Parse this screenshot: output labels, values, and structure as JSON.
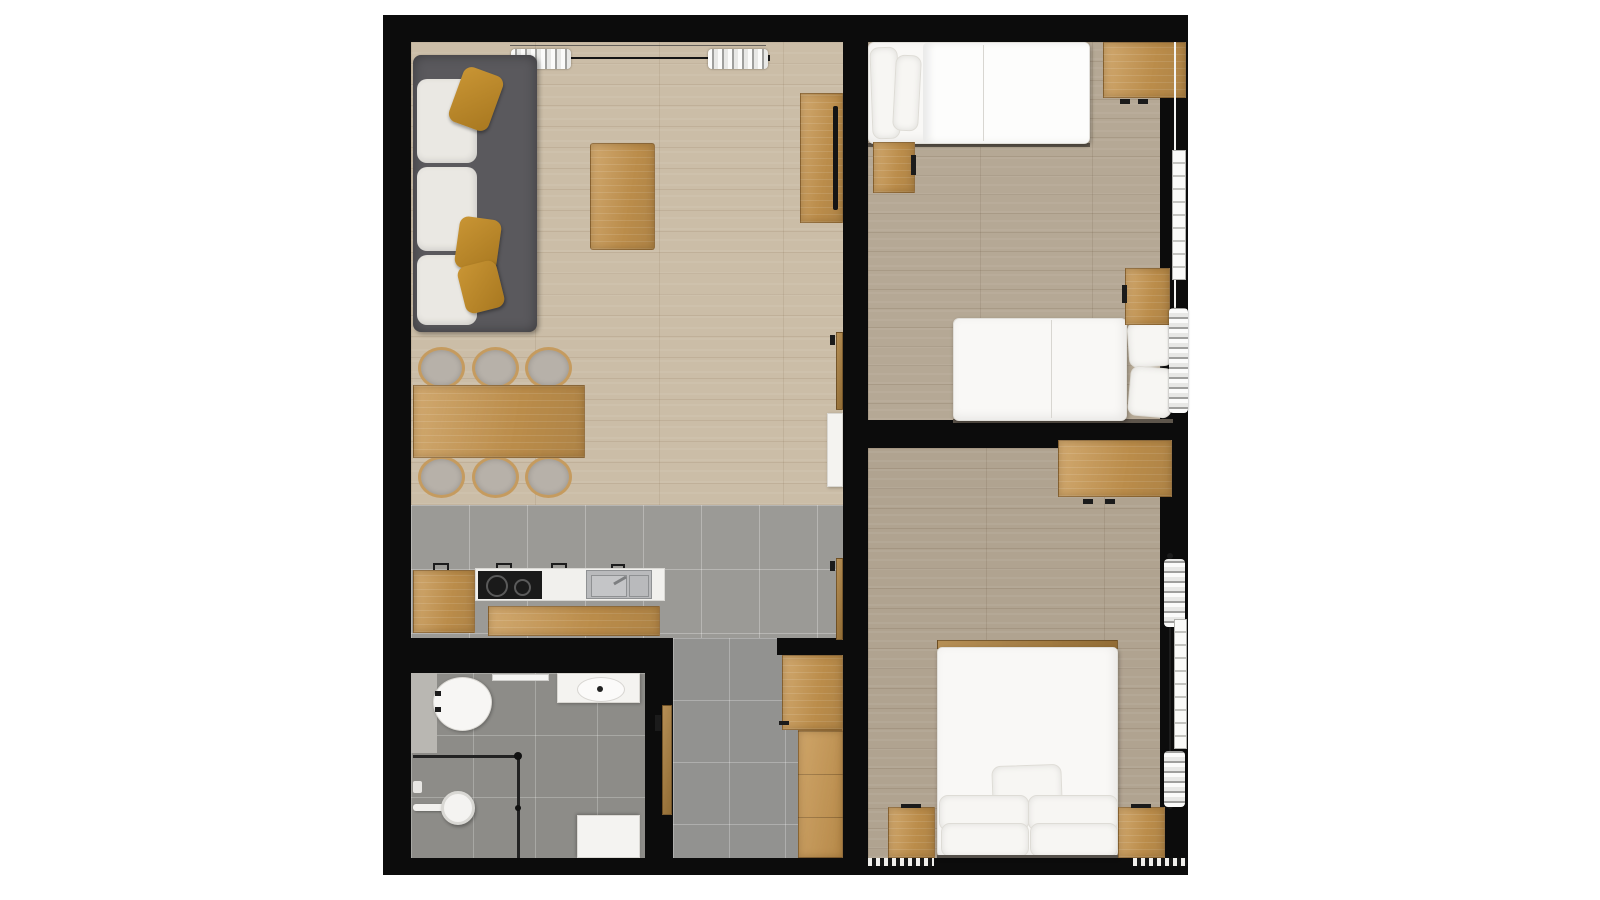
{
  "title": "Apartment floor plan",
  "type": "2D top-down rendered floor plan, no text labels",
  "palette": {
    "background": "#ffffff",
    "walls": "#0c0c0c",
    "living_wood_floor": "#cbbda7",
    "bedroom_wood_floor": "#b3a693",
    "kitchen_tile": "#9b9a96",
    "bathroom_tile": "#8d8c88",
    "oak_furniture": "#c6954f",
    "sofa_gray": "#5a595d",
    "accent_mustard": "#c18c2d",
    "white_furniture": "#f4f3f0"
  },
  "rooms": [
    {
      "name": "living-dining-kitchen",
      "position": "left half",
      "floors": [
        "light oak planks (living/dining)",
        "gray tile (kitchen strip)"
      ],
      "furniture": [
        "gray 3-seat sofa with 3 white cushions and 3 mustard pillows",
        "oak coffee table",
        "oak TV console with black TV against divider wall",
        "oak dining table with 6 upholstered chairs (3 per side)",
        "kitchen run: oak cabinet, black 2-burner cooktop, white counter, stainless sink",
        "oak kitchen island",
        "tall white cabinet and two oak door leaves on divider wall",
        "window with curtain rail and two curtain bunches on top wall"
      ]
    },
    {
      "name": "bathroom",
      "position": "bottom left",
      "floors": [
        "dark gray tile"
      ],
      "furniture": [
        "wall-hung toilet with cistern panel",
        "towel rail",
        "white washbasin counter with oval basin",
        "corner shower with glass partition, shower head and arm",
        "white shower tray/mat"
      ]
    },
    {
      "name": "hallway",
      "position": "bottom center",
      "floors": [
        "gray tile"
      ],
      "furniture": [
        "L-shaped oak wardrobe",
        "oak bathroom door leaf"
      ]
    },
    {
      "name": "bedroom-1",
      "position": "top right",
      "floors": [
        "gray-beige oak planks"
      ],
      "furniture": [
        "single bed with 2 pillows (head at left wall)",
        "single bed with 2 pillows (head at right window)",
        "oak desk at top right",
        "2 oak nightstands",
        "window with white curtain rail, radiator and curtain bunch on right wall"
      ]
    },
    {
      "name": "bedroom-2",
      "position": "bottom right",
      "floors": [
        "gray-beige oak planks"
      ],
      "furniture": [
        "double bed with duvet and 5 white pillows (head at bottom wall)",
        "2 oak nightstands flanking the bed",
        "oak desk at top right",
        "window with curtain rail, radiator and two curtain bunches on right wall",
        "dashed threshold marks along bottom wall"
      ]
    }
  ],
  "counts": {
    "windows": 3,
    "beds": 3,
    "dining_chairs": 6,
    "radiators": 2,
    "doors_visible": 3
  }
}
